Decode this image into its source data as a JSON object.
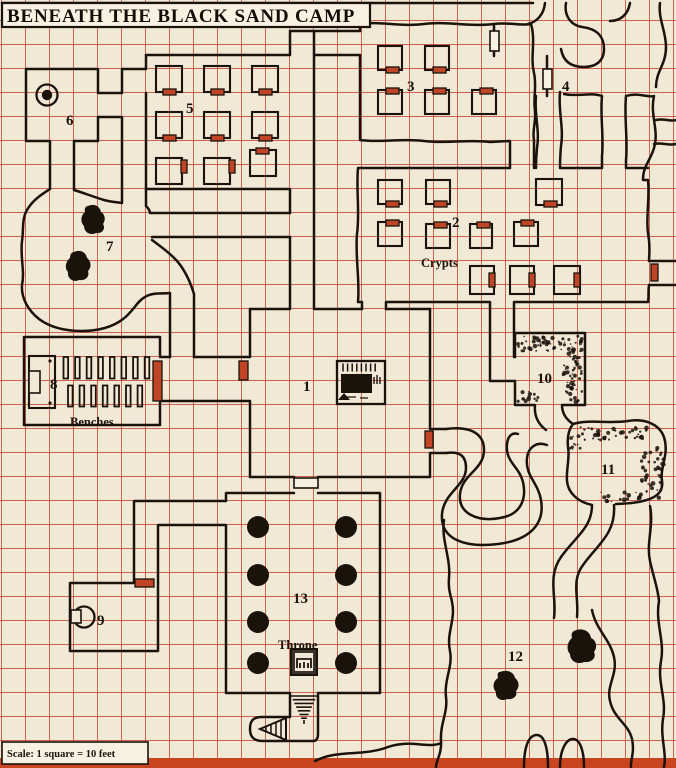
{
  "title": "BENEATH THE BLACK SAND CAMP",
  "scale_note": "Scale: 1 square = 10 feet",
  "colors": {
    "background": "#f0e9d6",
    "grid": "#c5402a",
    "wall": "#1a130c",
    "door_red": "#bf4526",
    "paper_box": "#f6f1e1",
    "bottom_bar": "#c8451f"
  },
  "rooms": [
    {
      "id": "1",
      "label": "1"
    },
    {
      "id": "2",
      "label": "2"
    },
    {
      "id": "3",
      "label": "3"
    },
    {
      "id": "4",
      "label": "4"
    },
    {
      "id": "5",
      "label": "5"
    },
    {
      "id": "6",
      "label": "6"
    },
    {
      "id": "7",
      "label": "7"
    },
    {
      "id": "8",
      "label": "8"
    },
    {
      "id": "9",
      "label": "9"
    },
    {
      "id": "10",
      "label": "10"
    },
    {
      "id": "11",
      "label": "11"
    },
    {
      "id": "12",
      "label": "12"
    },
    {
      "id": "13",
      "label": "13"
    }
  ],
  "features": {
    "crypts": "Crypts",
    "benches": "Benches",
    "throne": "Throne"
  },
  "icons": {
    "well": "well-icon (double circle, room 6 and room 9)",
    "door_red": "door-icon (red filled rectangle on wall)",
    "door_white": "door-icon (open rectangle on wall)",
    "pillar": "pillar-icon (solid black circle, room 13)",
    "stairs": "stairs-icon (converging steps below room 13)",
    "boulder": "boulder-icon (black blobs, rooms 7 and 12)",
    "rubble": "rubble-stipple (rooms 10 and 11)",
    "altar": "altar-icon (black block with steps, room 1)",
    "throne_seat": "throne-icon (room 13)",
    "benches": "bench-rows (room 8)"
  }
}
